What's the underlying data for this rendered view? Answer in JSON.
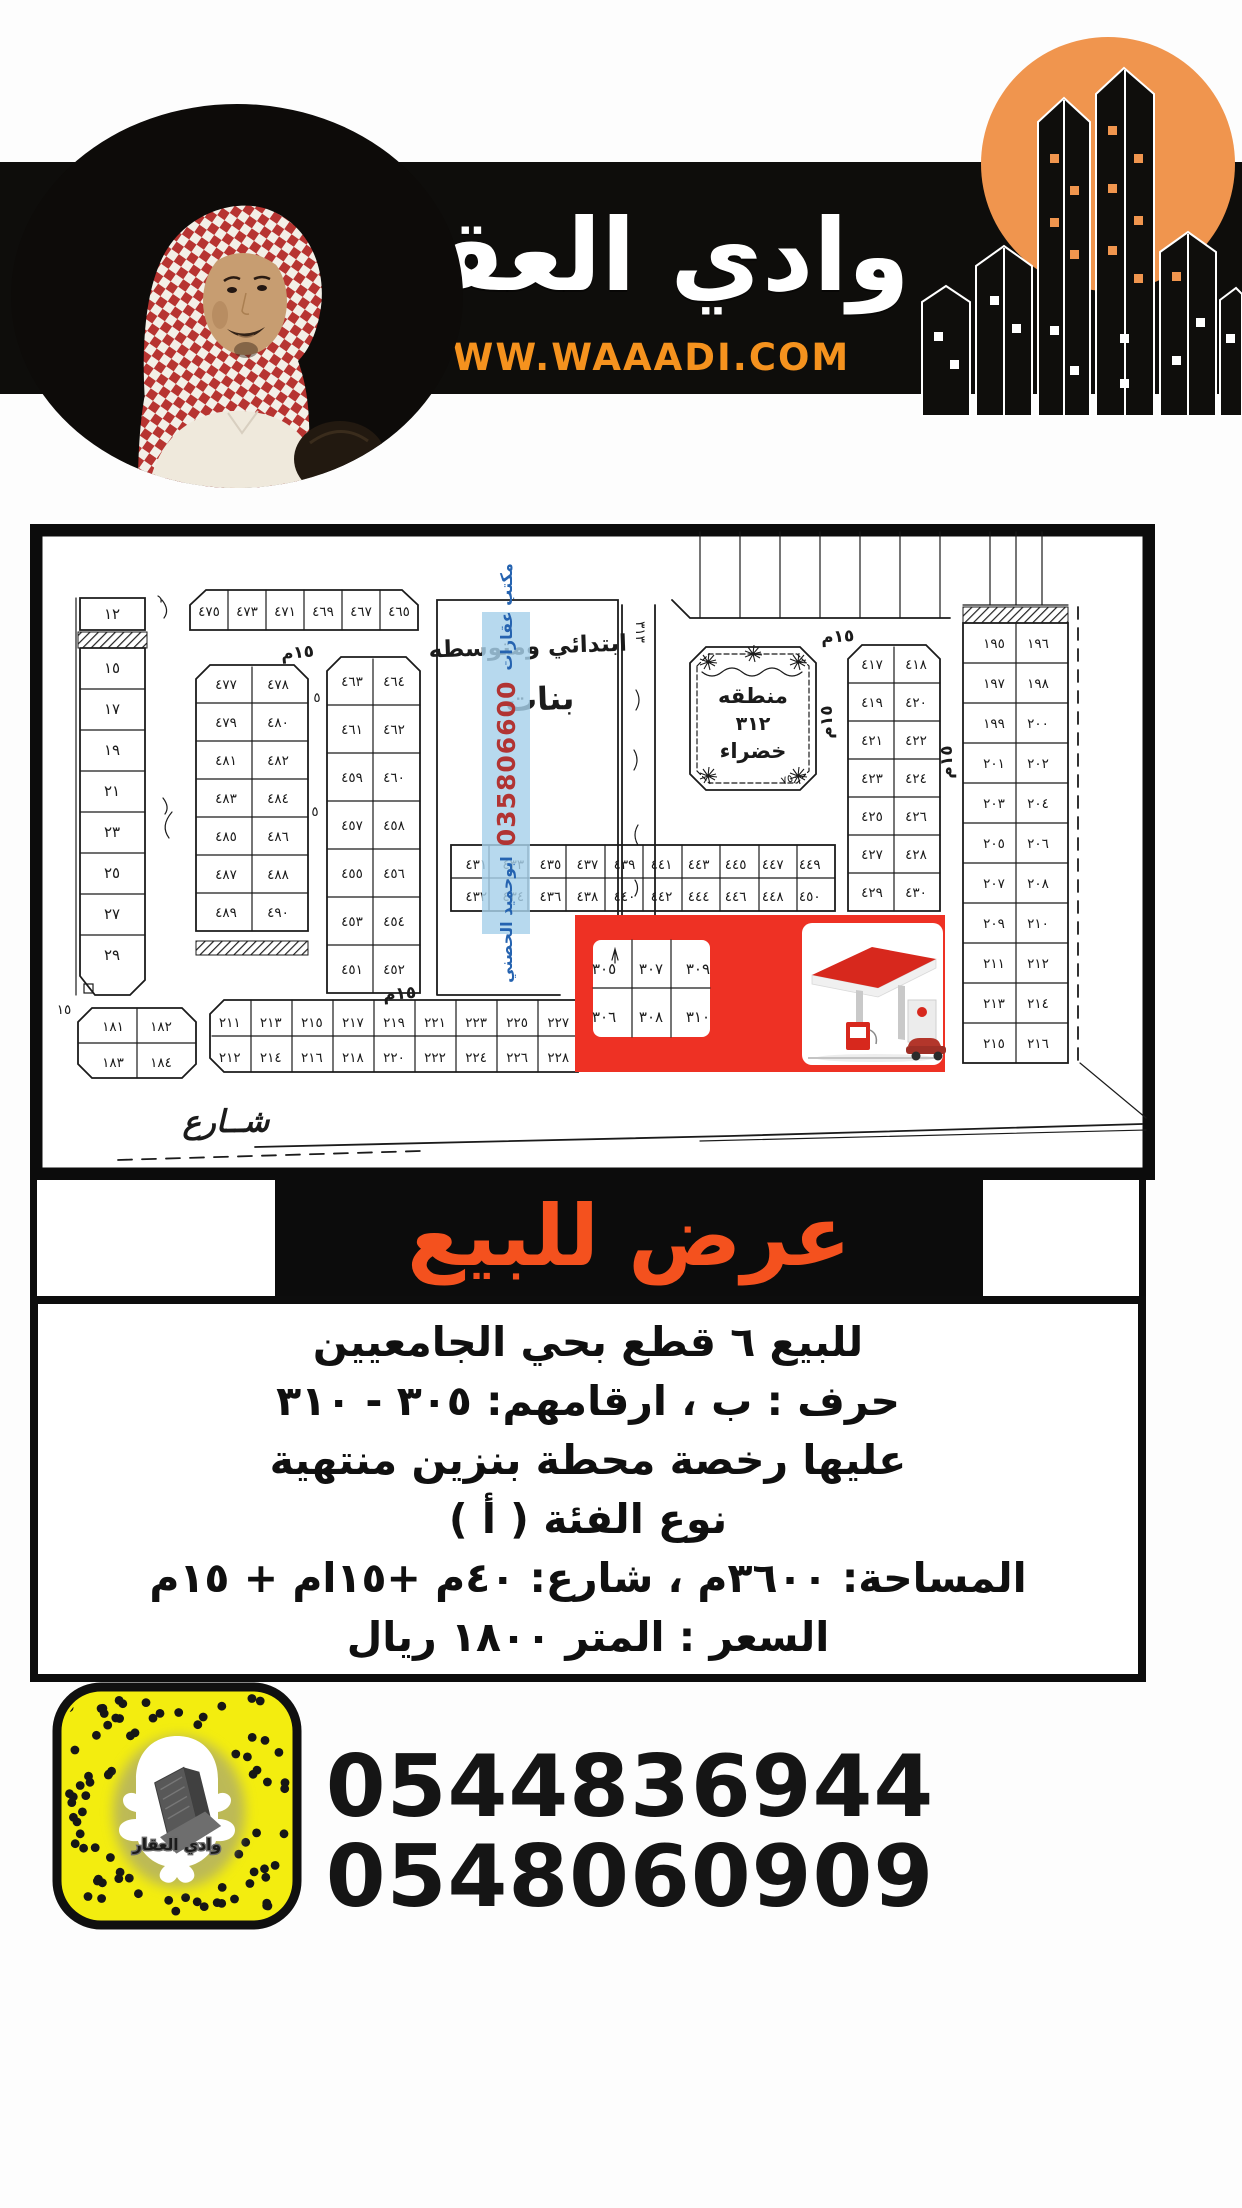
{
  "header": {
    "brand_title": "وادي العقار",
    "website": "WWW.WAAADI.COM",
    "band_color": "#0e0d0b",
    "orange": "#F5921E",
    "logo_circle_color": "#F0954E"
  },
  "map_section": {
    "school": {
      "line1": "ابتدائي ومتوسطه",
      "line2": "بنات"
    },
    "green_area": {
      "line1": "منطقه",
      "line2": "٣١٢",
      "line3": "خضراء",
      "note": "٧٥٠"
    },
    "watermark": {
      "office": "مكتب عقارات",
      "phone": "035806600",
      "name": "ابوحميد الحصني"
    },
    "street_main": "شــارع",
    "street_15m": "١٥م",
    "street_5": "٥",
    "strip_313": "٣١٣",
    "label_15": "١٥",
    "left_column": [
      "١٢",
      "١٥",
      "١٧",
      "١٩",
      "٢١",
      "٢٣",
      "٢٥",
      "٢٧",
      "٢٩"
    ],
    "block_a": [
      "٤٧٥",
      "٤٧٣",
      "٤٧١",
      "٤٦٩",
      "٤٦٧",
      "٤٦٥"
    ],
    "block_b": [
      "٤٧٨ ٤٧٧",
      "٤٨٠ ٤٧٩",
      "٤٨٢ ٤٨١",
      "٤٨٤ ٤٨٣",
      "٤٨٦ ٤٨٥",
      "٤٨٨ ٤٨٧",
      "٤٩٠ ٤٨٩"
    ],
    "block_c": [
      "٤٦٤ ٤٦٣",
      "٤٦٢ ٤٦١",
      "٤٦٠ ٤٥٩",
      "٤٥٨ ٤٥٧",
      "٤٥٦ ٤٥٥",
      "٤٥٤ ٤٥٣",
      "٤٥٢ ٤٥١"
    ],
    "block_d": [
      "١٩٦ ١٩٥",
      "١٩٨ ١٩٧",
      "٢٠٠ ١٩٩",
      "٢٠٢ ٢٠١",
      "٢٠٤ ٢٠٣",
      "٢٠٦ ٢٠٥",
      "٢٠٨ ٢٠٧",
      "٢١٠ ٢٠٩",
      "٢١٢ ٢١١",
      "٢١٤ ٢١٣",
      "٢١٦ ٢١٥"
    ],
    "block_e": [
      "٤١٨ ٤١٧",
      "٤٢٠ ٤١٩",
      "٤٢٢ ٤٢١",
      "٤٢٤ ٤٢٣",
      "٤٢٦ ٤٢٥",
      "٤٢٨ ٤٢٧",
      "٤٣٠ ٤٢٩"
    ],
    "strip_f_top": "٤٤٩ ٤٤٧ ٤٤٥ ٤٤٣ ٤٤١ ٤٣٩ ٤٣٧ ٤٣٥ ٤٣٣ ٤٣١",
    "strip_f_bottom": "٤٥٠ ٤٤٨ ٤٤٦ ٤٤٤ ٤٤٢ ٤٤٠ ٤٣٨ ٤٣٦ ٤٣٤ ٤٣٢",
    "strip_g_top": "٢٢٧ ٢٢٥ ٢٢٣ ٢٢١ ٢١٩ ٢١٧ ٢١٥ ٢١٣ ٢١١",
    "strip_g_bottom": "٢٢٨ ٢٢٦ ٢٢٤ ٢٢٢ ٢٢٠ ٢١٨ ٢١٦ ٢١٤ ٢١٢",
    "block_h": [
      "١٨٢ ١٨١",
      "١٨٤ ١٨٣"
    ],
    "highlight": {
      "color": "#EE3124",
      "plots_top": "٣٠٩ ٣٠٧ ٣٠٥",
      "plots_bottom": "٣١٠ ٣٠٨ ٣٠٦"
    }
  },
  "banner": {
    "text": "عرض للبيع",
    "text_color": "#F4511E"
  },
  "details": {
    "lines": [
      "للبيع ٦ قطع بحي الجامعيين",
      "حرف : ب ، ارقامهم: ٣٠٥ - ٣١٠",
      "عليها رخصة محطة بنزين منتهية",
      "نوع الفئة ( أ )",
      "المساحة: ٣٦٠٠م ، شارع: ٤٠م +١٥ام + ١٥م",
      "السعر : المتر ١٨٠٠ ريال"
    ]
  },
  "contact": {
    "phone1": "0544836944",
    "phone2": "0548060909",
    "snapcode_label": "وادي العقار",
    "snap_yellow": "#F3ED0F"
  }
}
